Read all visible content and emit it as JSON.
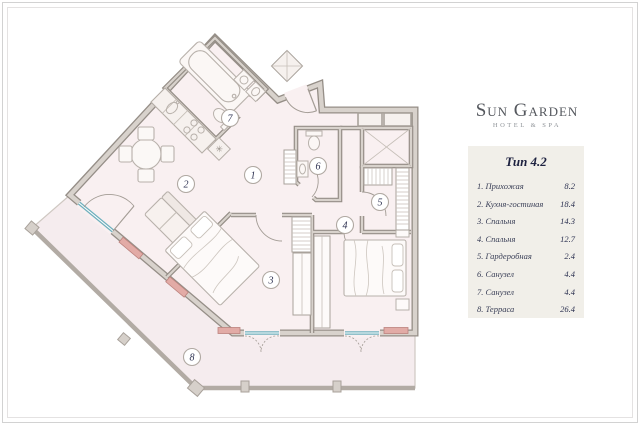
{
  "brand": {
    "name": "Sun Garden",
    "tagline": "HOTEL & SPA"
  },
  "card": {
    "title": "Тип 4.2",
    "rows": [
      {
        "label": "1. Прихожая",
        "area": "8.2"
      },
      {
        "label": "2. Кухня-гостиная",
        "area": "18.4"
      },
      {
        "label": "3. Спальня",
        "area": "14.3"
      },
      {
        "label": "4. Спальня",
        "area": "12.7"
      },
      {
        "label": "5. Гардеробная",
        "area": "2.4"
      },
      {
        "label": "6. Санузел",
        "area": "4.4"
      },
      {
        "label": "7. Санузел",
        "area": "4.4"
      },
      {
        "label": "8. Терраса",
        "area": "26.4"
      }
    ]
  },
  "plan": {
    "room_labels": [
      "1",
      "2",
      "3",
      "4",
      "5",
      "6",
      "7",
      "8"
    ]
  },
  "colors": {
    "wall": "#958e87",
    "wall_fill": "#d8d2cc",
    "floor": "#f9f0f1",
    "terrace": "#f5ecee",
    "glass": "#6fb0bd",
    "radiator": "#e2aba6",
    "accent_text": "#1e2240"
  }
}
